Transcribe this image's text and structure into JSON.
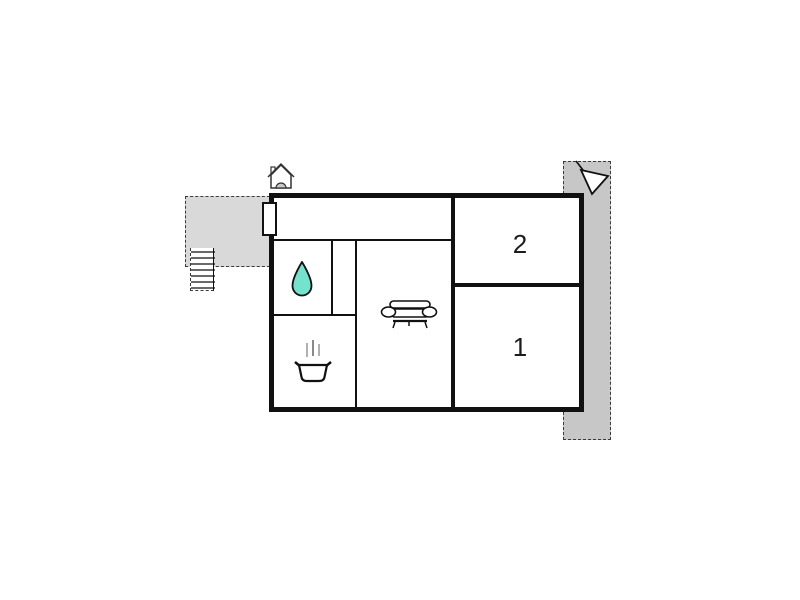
{
  "floor_plan": {
    "type": "apartment floor plan",
    "rooms": {
      "bedroom_2": {
        "label": "2"
      },
      "bedroom_1": {
        "label": "1"
      },
      "bathroom": {
        "icon": "water-drop-icon"
      },
      "kitchen": {
        "icon": "cooking-pot-icon"
      },
      "living_room": {
        "icon": "sofa-icon"
      },
      "hallway": {}
    },
    "features": {
      "entrance_marker": {
        "icon": "entrance-house-icon"
      },
      "entrance_door": {
        "type": "door-opening"
      },
      "stairs": {
        "icon": "stairs-icon",
        "step_count": 7
      },
      "terrace_left": {
        "fill": "#d9d9d9",
        "outline": "dashed"
      },
      "terrace_right": {
        "fill": "#c7c7c7",
        "outline": "dashed"
      },
      "view_arrow": {
        "icon": "view-direction-arrow-icon"
      }
    },
    "colors": {
      "wall": "#111111",
      "water_drop_fill": "#74e3cd",
      "steam_gray": "#b0b0b0",
      "background": "#ffffff"
    }
  }
}
